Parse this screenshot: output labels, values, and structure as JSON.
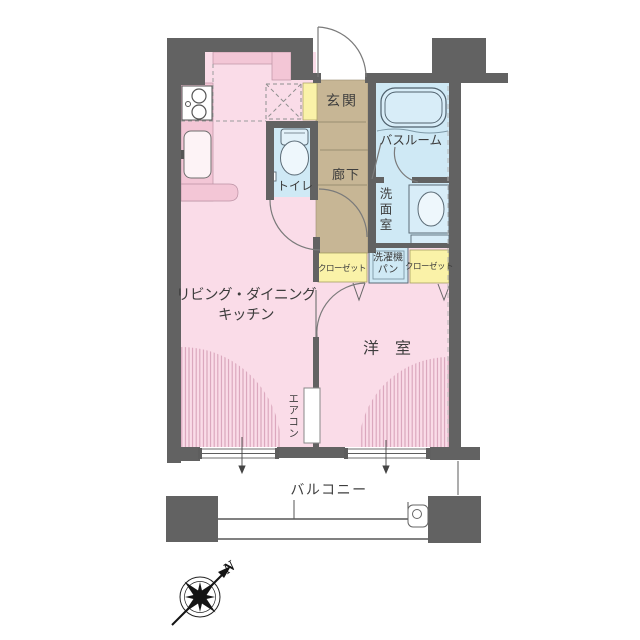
{
  "plan": {
    "type": "apartment-floorplan",
    "labels": {
      "entrance": "玄関",
      "bathroom": "バスルーム",
      "corridor": "廊下",
      "toilet": "トイレ",
      "washroom": "洗面室",
      "laundry_pan": "洗濯機パン",
      "closet_left": "クローゼット",
      "closet_right": "クローゼット",
      "living_dining_kitchen": "リビング・ダイニング\nキッチン",
      "western_room": "洋　室",
      "aircon": "エアコン",
      "balcony": "バルコニー",
      "compass_north": "N"
    },
    "icons": {
      "compass": "compass-rose-icon",
      "stove": "stove-burners-icon",
      "sink": "kitchen-sink-icon",
      "bathtub": "bathtub-icon",
      "toilet": "toilet-bowl-icon",
      "basin": "wash-basin-icon",
      "drain": "balcony-drain-icon"
    },
    "colors": {
      "wall": "#626262",
      "room_pink": "#fadce8",
      "counter_pink": "#f3c6d6",
      "hatch_stripe": "#d7a2b8",
      "wet_blue": "#cfe9f5",
      "fixture_blue": "#e2f1f9",
      "hall_beige": "#c7b695",
      "closet_yellow": "#faf2a8",
      "line": "#777777"
    }
  }
}
